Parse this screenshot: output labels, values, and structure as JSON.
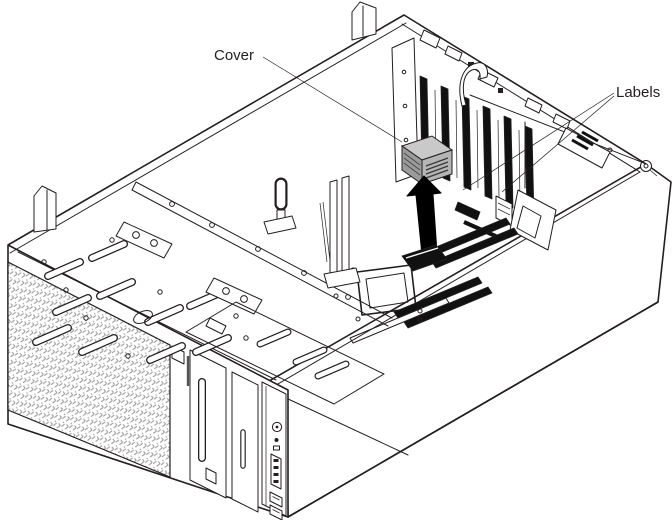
{
  "figure": {
    "type": "technical-line-illustration",
    "description": "Isometric exploded line drawing of a tower server lying on its side with the side cover removed; a small gray cover is lifted out of the system board, indicated by a large upward black arrow. Callout lines point to the cover and to labels inside the chassis.",
    "background_color": "#ffffff",
    "line_color": "#231f20",
    "cover_fill_top": "#c9c9c9",
    "cover_fill_side": "#9b9b9b",
    "arrow_fill": "#000000",
    "mesh_color": "#9a9a9a"
  },
  "callouts": {
    "cover": {
      "label": "Cover"
    },
    "labels": {
      "label": "Labels"
    }
  }
}
